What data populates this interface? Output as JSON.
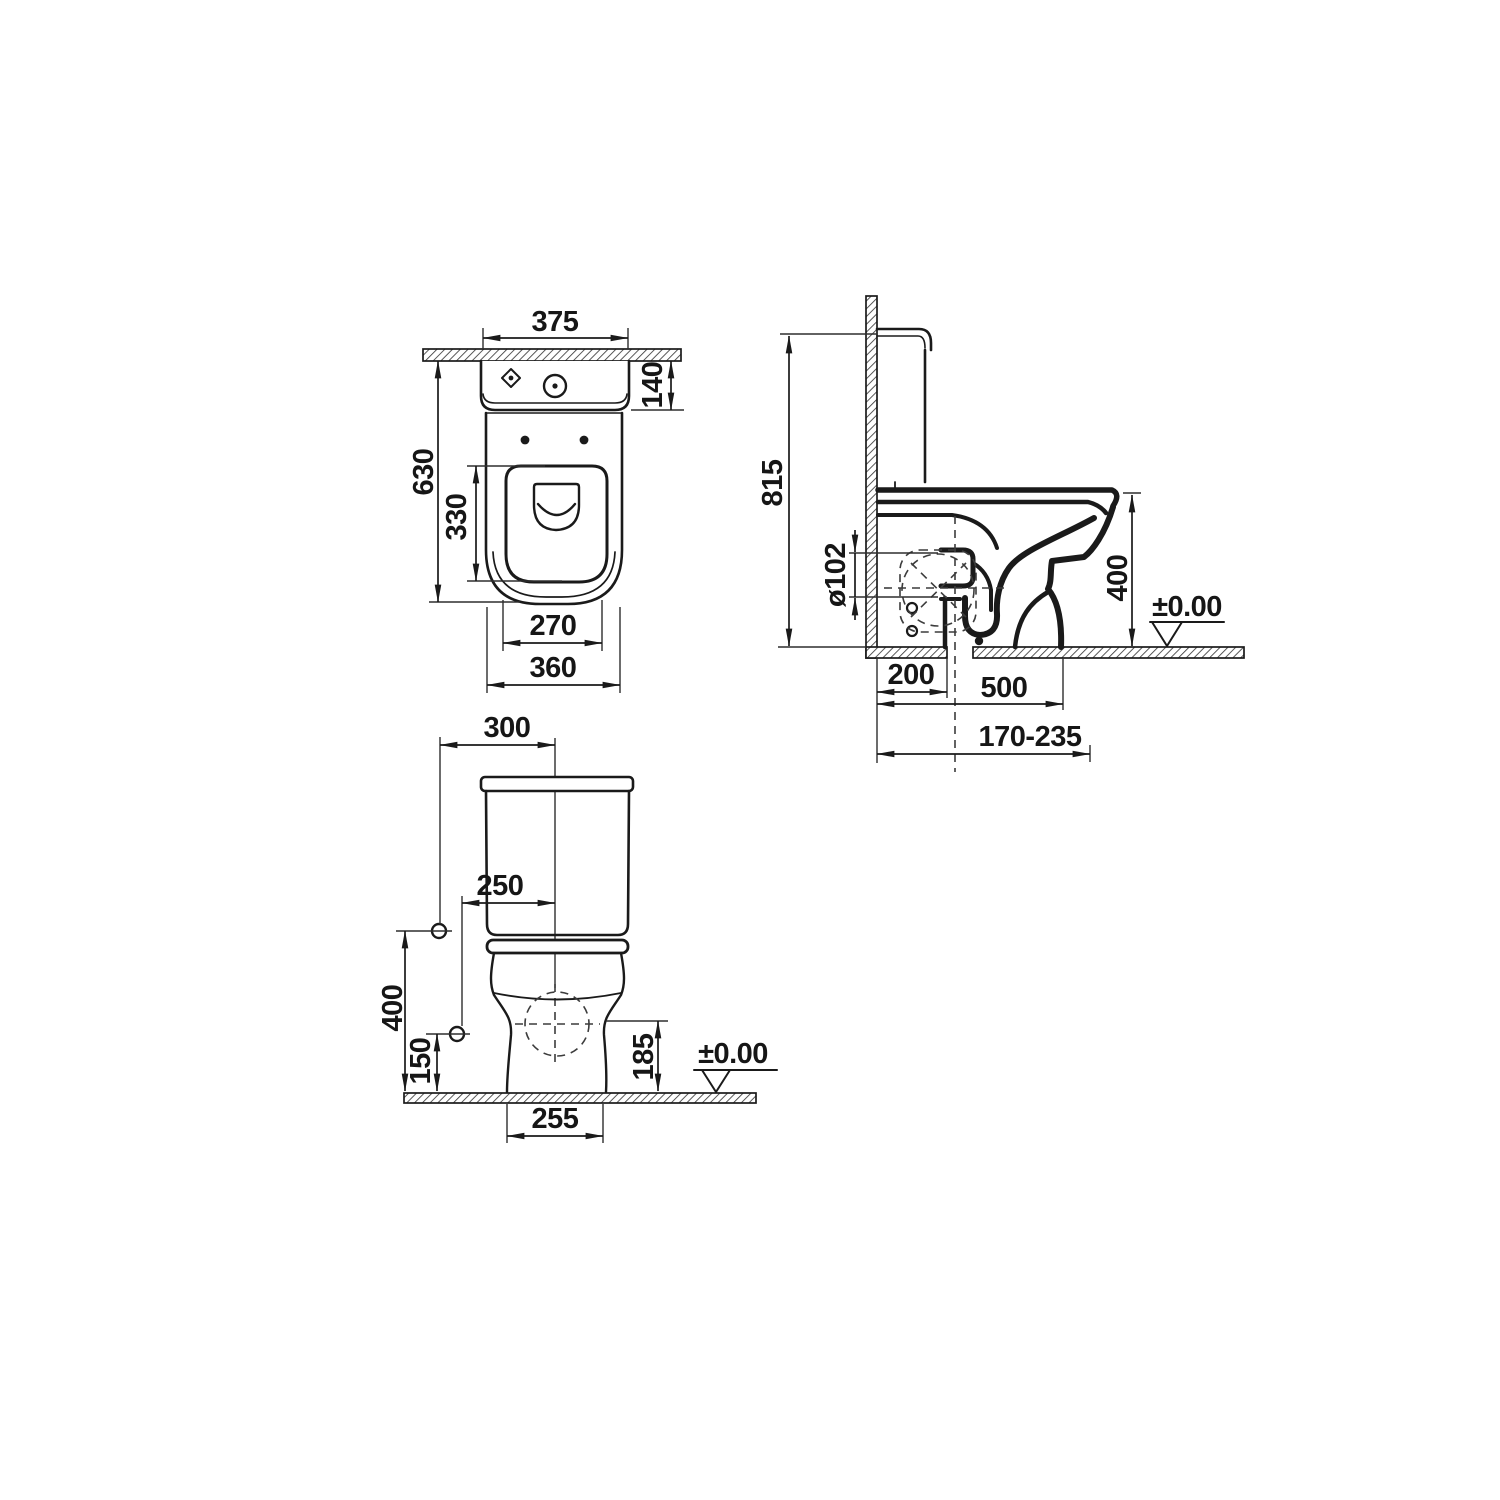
{
  "page": {
    "background": "#ffffff",
    "description": "Technical installation drawing of a close-coupled WC (toilet) shown in three orthographic views with millimetre dimensions"
  },
  "drawing": {
    "line_color": "#1a1a1a",
    "views": {
      "plan": {
        "label": "top view",
        "dims": {
          "cistern_width": "375",
          "cistern_depth": "140",
          "overall_depth": "630",
          "opening_depth": "330",
          "outlet_width": "270",
          "bowl_width": "360"
        }
      },
      "side": {
        "label": "side section view",
        "dims": {
          "overall_height": "815",
          "outlet_diameter": "ø102",
          "rim_height": "400",
          "floor_level": "±0.00",
          "wall_to_fixing": "200",
          "wall_to_outlet": "500",
          "outlet_adjustment": "170-235"
        }
      },
      "front": {
        "label": "front view",
        "dims": {
          "center_to_edge": "300",
          "fixing_hole_offset": "250",
          "upper_fixing_height": "400",
          "lower_fixing_height": "150",
          "outlet_height": "185",
          "base_width": "255",
          "floor_level": "±0.00"
        }
      }
    }
  }
}
